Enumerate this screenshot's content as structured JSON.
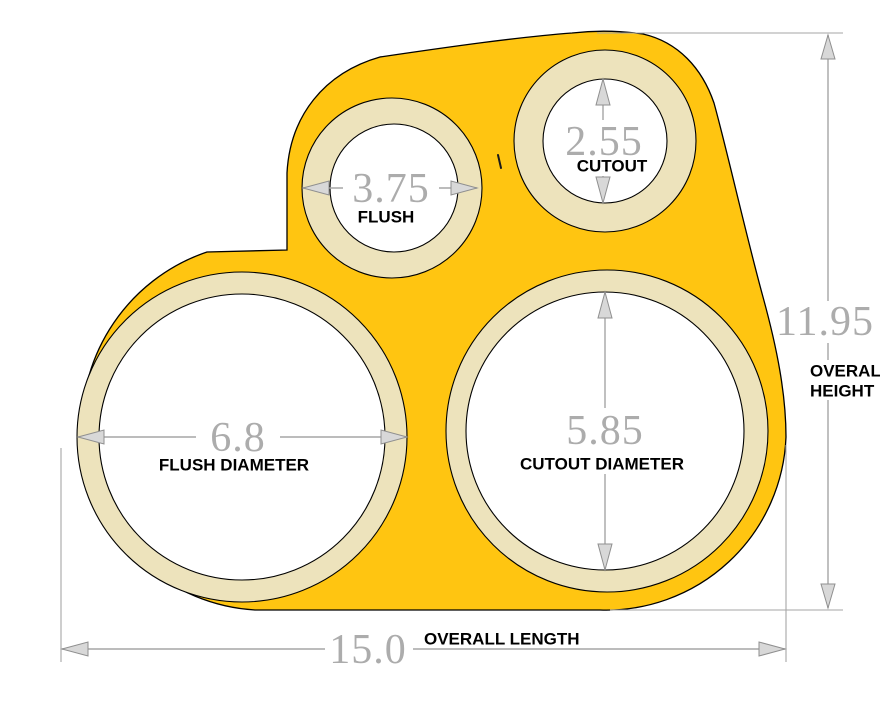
{
  "colors": {
    "body_yellow": "#FFC511",
    "ring_beige": "#EDE3BC",
    "hole_white": "#FFFFFF",
    "outline_black": "#000000",
    "dimension_gray": "#A6A6A6",
    "dim_text_gray": "#ACACAC",
    "label_black": "#000000"
  },
  "dimensions": {
    "flush_top": {
      "value": "3.75",
      "label": "FLUSH"
    },
    "cutout_top": {
      "value": "2.55",
      "label": "CUTOUT"
    },
    "flush_main": {
      "value": "6.8",
      "label": "FLUSH DIAMETER"
    },
    "cutout_main": {
      "value": "5.85",
      "label": "CUTOUT DIAMETER"
    },
    "overall_height": {
      "value": "11.95",
      "label_line1": "OVERALL",
      "label_line2": "HEIGHT"
    },
    "overall_length": {
      "value": "15.0",
      "label": "OVERALL LENGTH"
    }
  }
}
